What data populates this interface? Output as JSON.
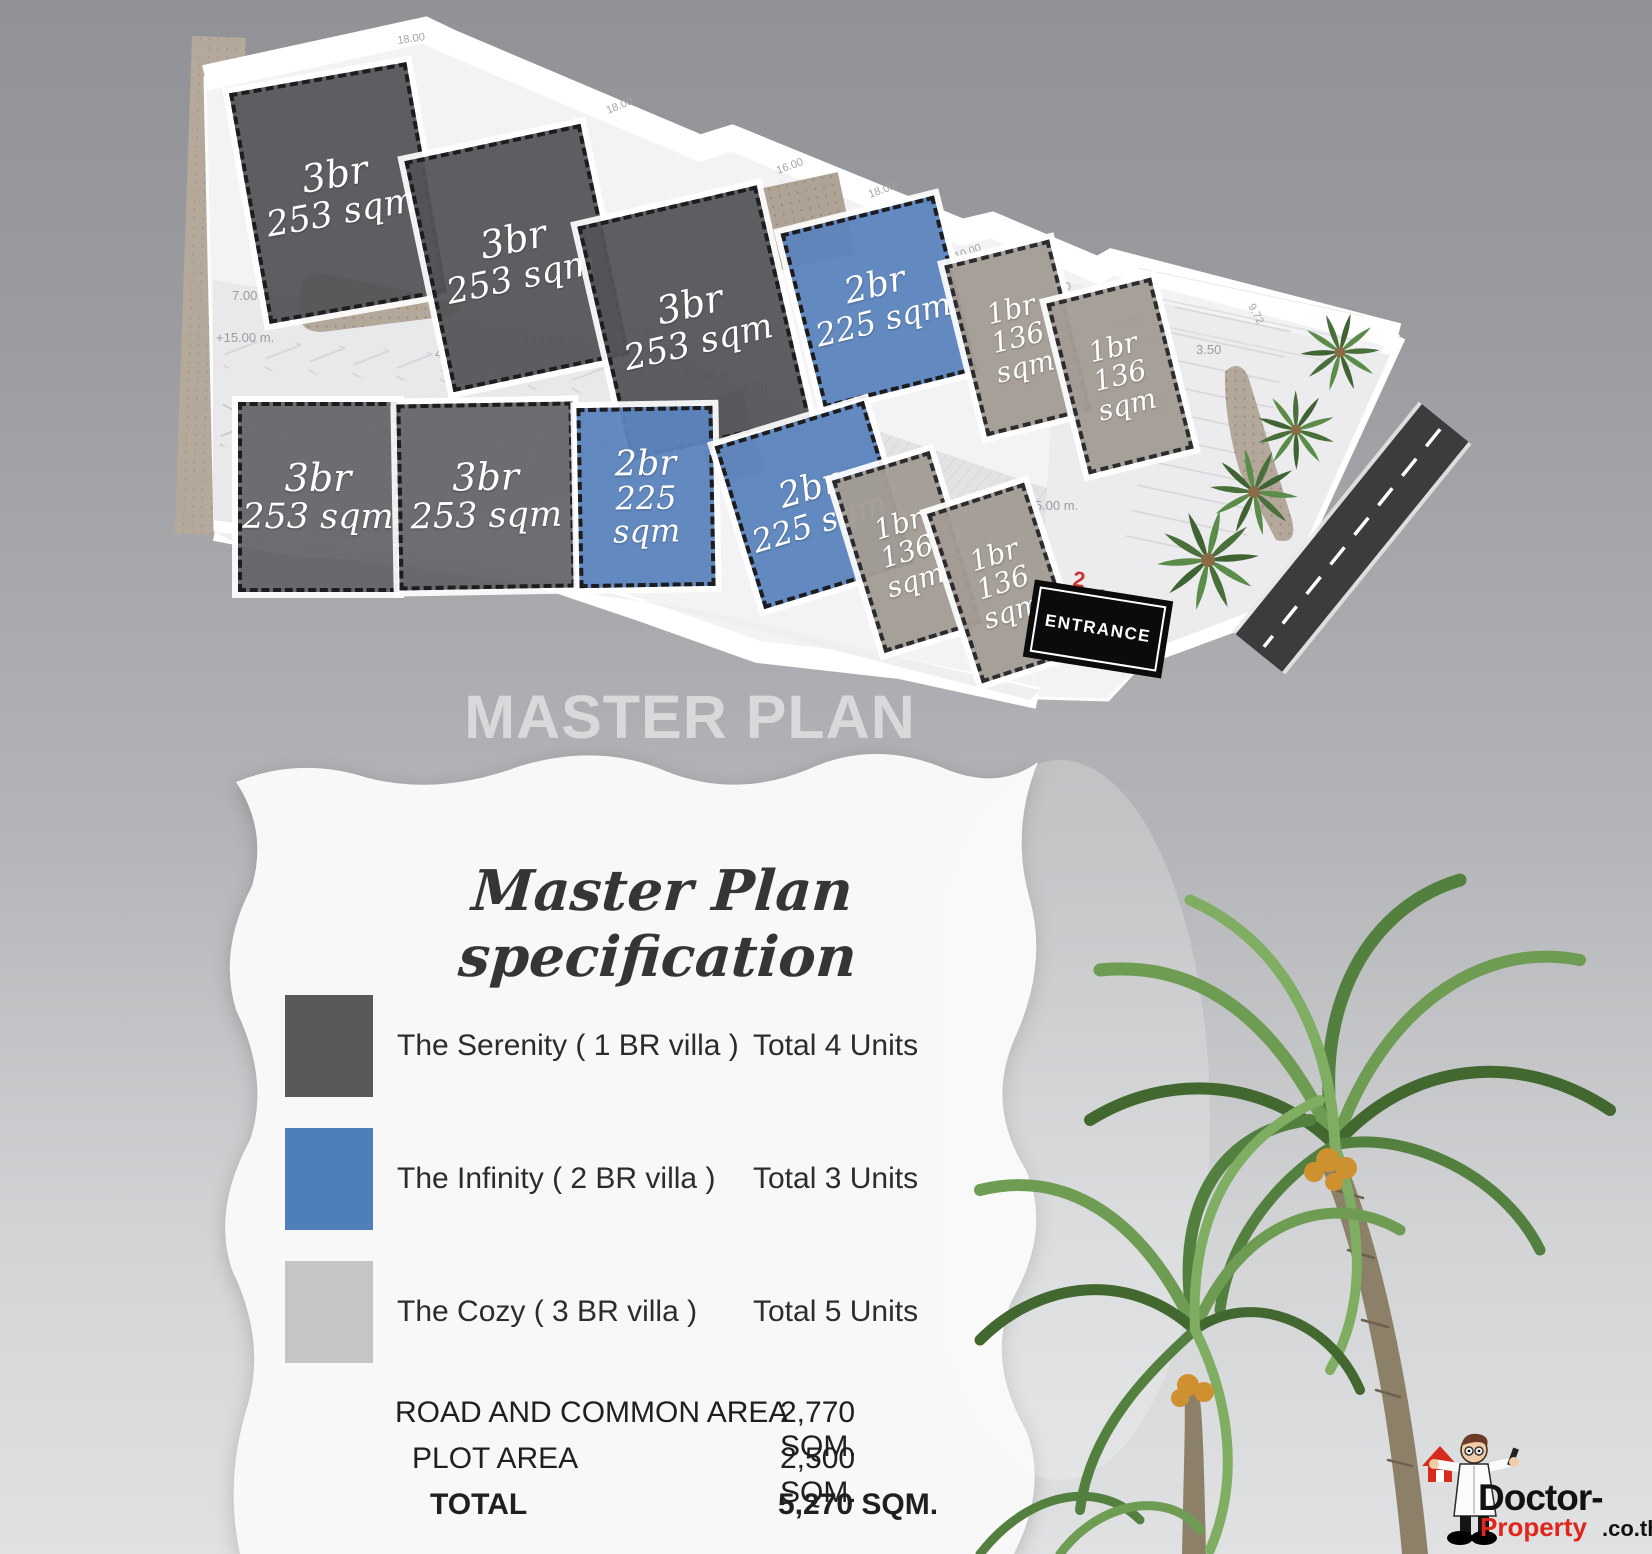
{
  "header": {
    "plan_title": "MASTER PLAN"
  },
  "entrance": {
    "label": "ENTRANCE"
  },
  "plan": {
    "plots": [
      {
        "l1": "3br",
        "l2": "253 sqm"
      },
      {
        "l1": "3br",
        "l2": "253 sqm"
      },
      {
        "l1": "3br",
        "l2": "253 sqm"
      },
      {
        "l1": "2br",
        "l2": "225 sqm"
      },
      {
        "l1": "1br",
        "l2": "136",
        "l3": "sqm"
      },
      {
        "l1": "1br",
        "l2": "136",
        "l3": "sqm"
      },
      {
        "l1": "3br",
        "l2": "253 sqm"
      },
      {
        "l1": "3br",
        "l2": "253 sqm"
      },
      {
        "l1": "2br",
        "l2": "225 sqm"
      },
      {
        "l1": "2br",
        "l2": "225 sqm"
      },
      {
        "l1": "1br",
        "l2": "136",
        "l3": "sqm"
      },
      {
        "l1": "1br",
        "l2": "136",
        "l3": "sqm"
      }
    ],
    "measurements": [
      "7.00",
      "+15.00 m.",
      "4.50",
      "4.50",
      "+15.00 m.",
      "+15.00 m.",
      "4.50",
      "7.10",
      "7.50",
      "+15.00 m.",
      "11.08",
      "3.50",
      "3.50",
      "9.72",
      "18.00",
      "18.00",
      "18.00",
      "16.00",
      "10.00",
      "10.00",
      "5.00",
      "3.50",
      "+15.00 m."
    ],
    "red_marker": "2"
  },
  "spec": {
    "title": "Master Plan specification",
    "legend": [
      {
        "name": "The Serenity ( 1 BR villa )",
        "total": "Total 4 Units",
        "color": "#58595b"
      },
      {
        "name": "The Infinity  ( 2 BR villa )",
        "total": "Total 3 Units",
        "color": "#4f7fba"
      },
      {
        "name": "The Cozy ( 3 BR villa )",
        "total": "Total 5 Units",
        "color": "#c4c5c7"
      }
    ],
    "totals": [
      {
        "label": "ROAD AND COMMON AREA",
        "value": "2,770 SQM."
      },
      {
        "label": "PLOT  AREA",
        "value": "2,500 SQM."
      },
      {
        "label": "TOTAL",
        "value": "5,270 SQM."
      }
    ]
  },
  "logo": {
    "line1": "Doctor-",
    "line2": "Property",
    "suffix": ".co.th"
  },
  "colors": {
    "villa_3br": "#58595b",
    "villa_2br": "#4f7fba",
    "villa_1br": "#a39c94",
    "road": "#3c3c3f",
    "entrance_bg": "#0b0b0c",
    "background_top": "#919296",
    "background_bottom": "#e0e1e3",
    "logo_red": "#e0261b"
  }
}
